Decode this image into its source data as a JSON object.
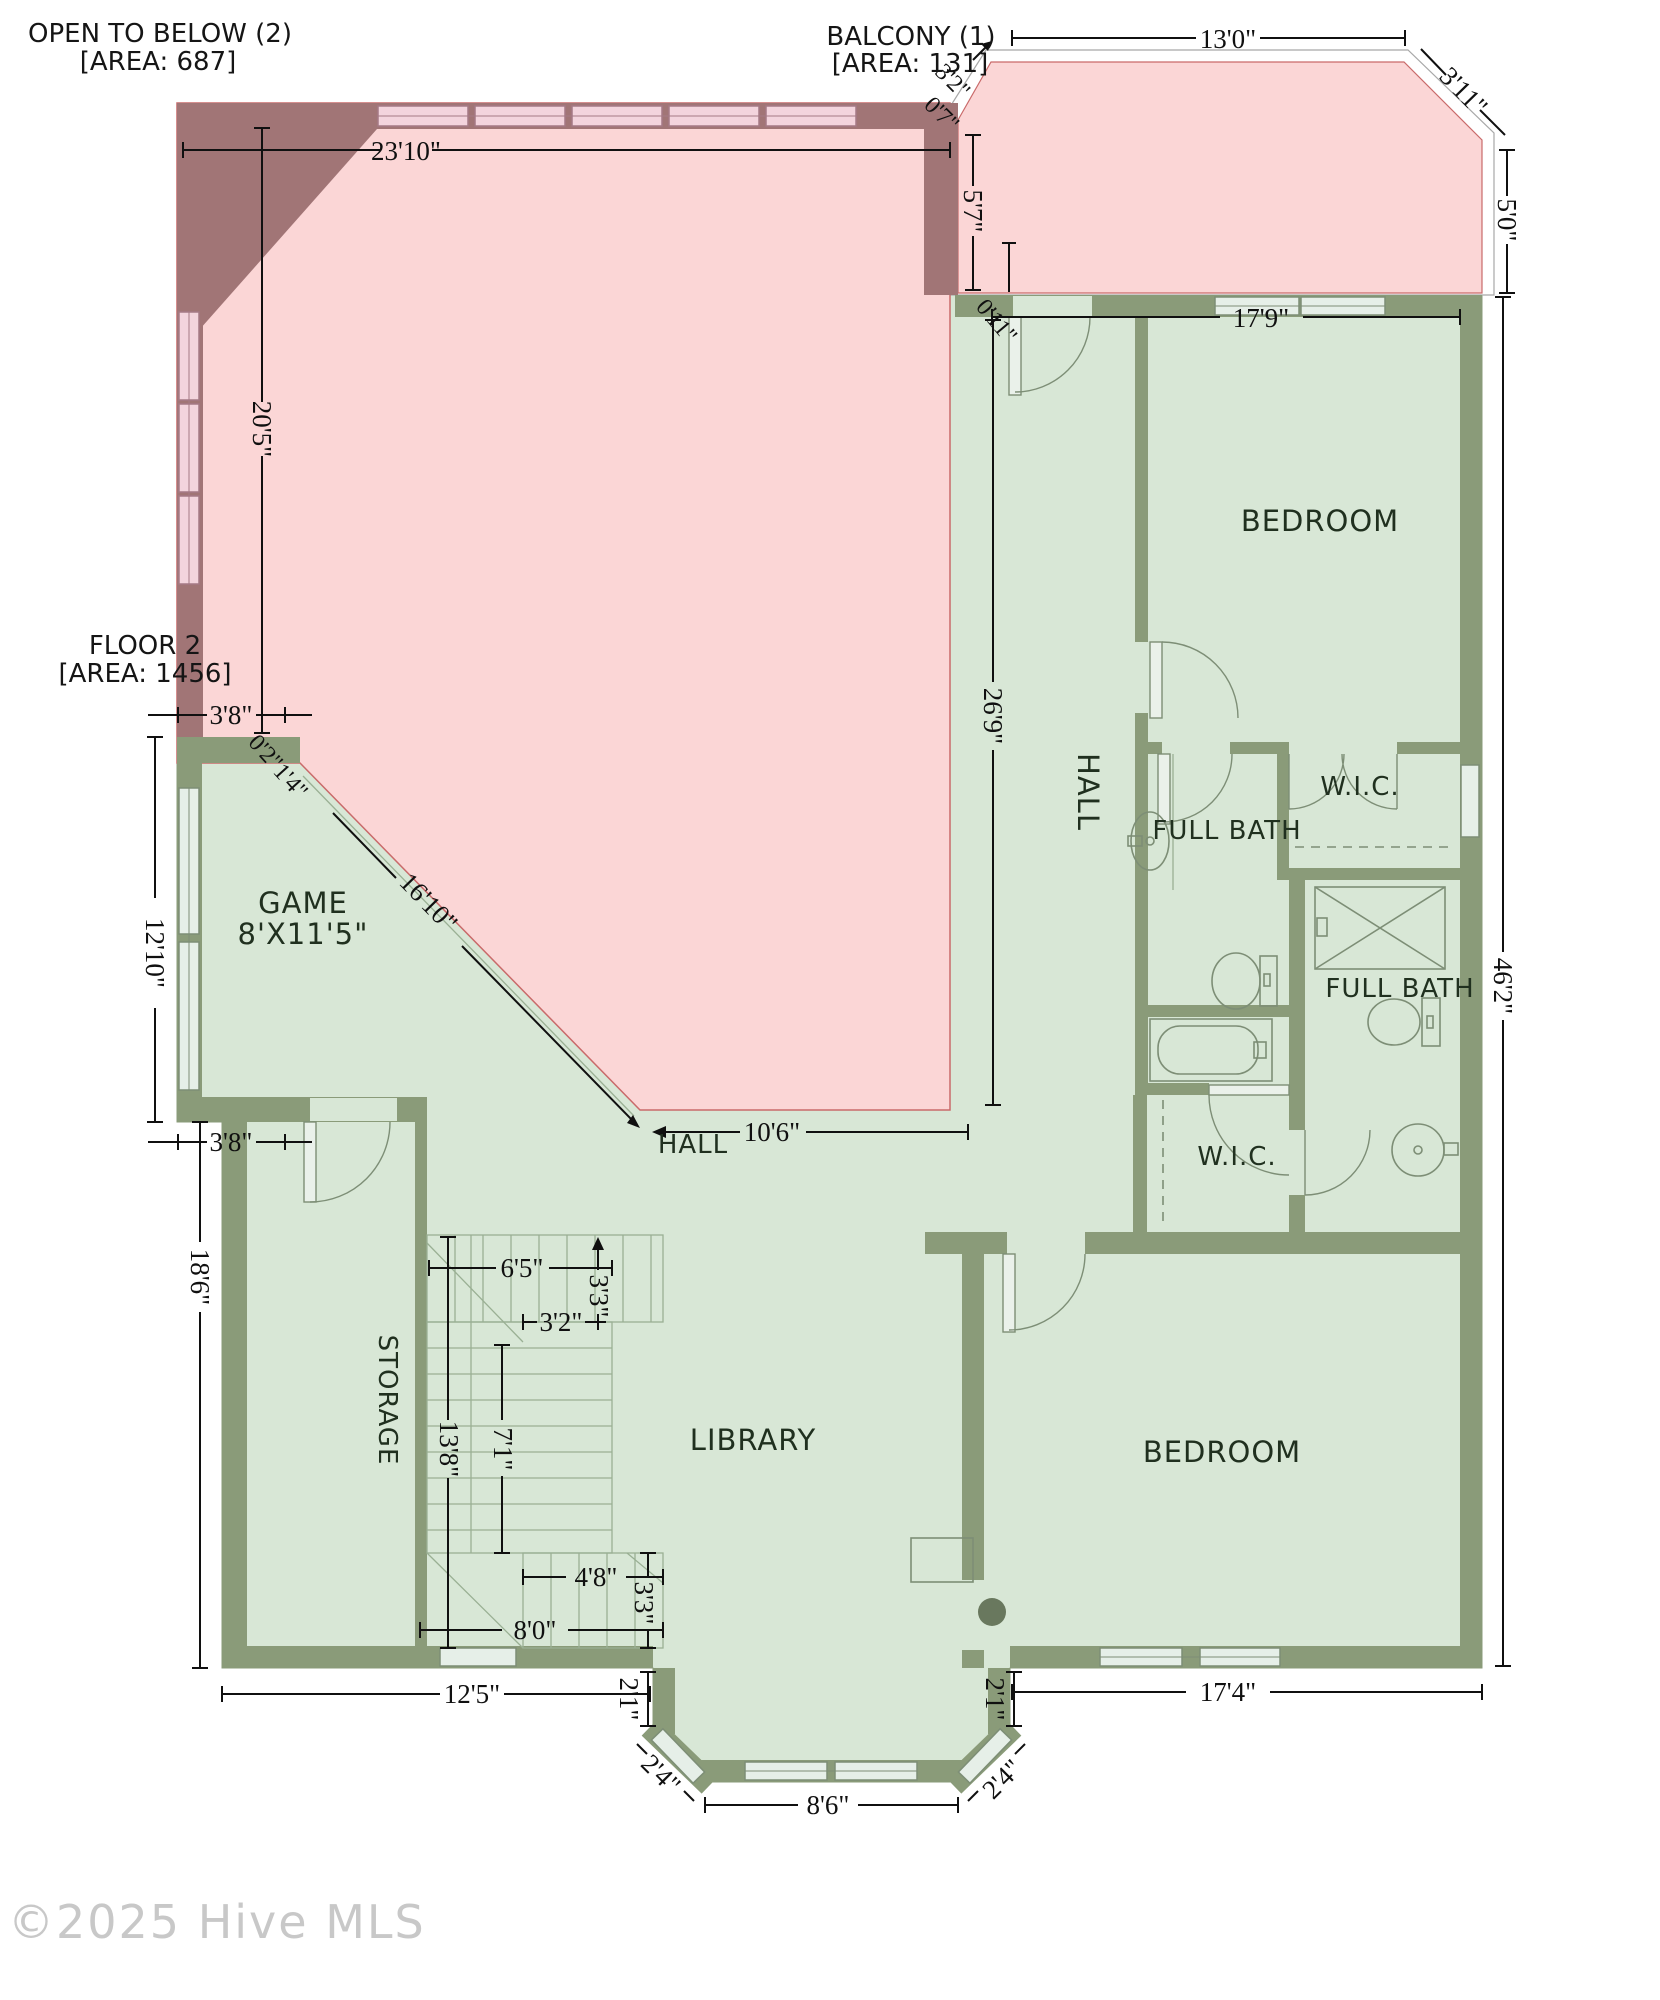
{
  "legend": {
    "open_to_below": {
      "title": "OPEN TO BELOW (2)",
      "area": "[AREA: 687]"
    },
    "balcony": {
      "title": "BALCONY (1)",
      "area": "[AREA: 131]"
    },
    "floor2": {
      "title": "FLOOR 2",
      "area": "[AREA: 1456]"
    }
  },
  "rooms": {
    "bedroom_top": "BEDROOM",
    "hall_upper": "HALL",
    "wic_top": "W.I.C.",
    "full_bath_top": "FULL BATH",
    "full_bath_bottom": "FULL BATH",
    "wic_mid": "W.I.C.",
    "game_title": "GAME",
    "game_size": "8'X11'5\"",
    "hall_lower": "HALL",
    "storage": "STORAGE",
    "library": "LIBRARY",
    "bedroom_bottom": "BEDROOM"
  },
  "dims": {
    "open_width": "23'10\"",
    "open_height": "20'5\"",
    "balcony_width": "13'0\"",
    "balcony_corner": "3'11\"",
    "balcony_right": "5'0\"",
    "balcony_left": "5'7\"",
    "balcony_diag": "3'2\"",
    "balcony_offset": "0'7\"",
    "hall_offset": "0'11\"",
    "bedroom_top_width": "17'9\"",
    "hall_height": "26'9\"",
    "right_height": "46'2\"",
    "game_top_width": "3'8\"",
    "game_left_height": "12'10\"",
    "game_step": "3'8\"",
    "game_diag": "16'10\"",
    "game_corner_offset": "0'2\"",
    "game_corner_diag": "1'4\"",
    "hall_lower_width": "10'6\"",
    "stair_top_width": "6'5\"",
    "stair_top_height": "3'3\"",
    "stair_mid_width": "3'2\"",
    "stair_left_height": "13'8\"",
    "stair_run_height": "7'1\"",
    "stair_bottom_width": "4'8\"",
    "stair_bottom_height": "3'3\"",
    "stair_total_width": "8'0\"",
    "storage_height": "18'6\"",
    "storage_width": "12'5\"",
    "bay_left_step": "2'1\"",
    "bay_left_diag": "2'4\"",
    "bay_width": "8'6\"",
    "bay_right_diag": "2'4\"",
    "bay_right_step": "2'1\"",
    "bedroom_bottom_width": "17'4\""
  },
  "watermark": "©2025 Hive MLS",
  "colors": {
    "open_area": "#fbd6d6",
    "overhang": "#a17576",
    "floor": "#d8e7d6",
    "wall": "#8a9b79",
    "window_green": "#e6efe8",
    "window_pink": "#f3d4dd",
    "dimension_text": "#101010",
    "room_text": "#20301f",
    "watermark": "#c8c8c8"
  }
}
